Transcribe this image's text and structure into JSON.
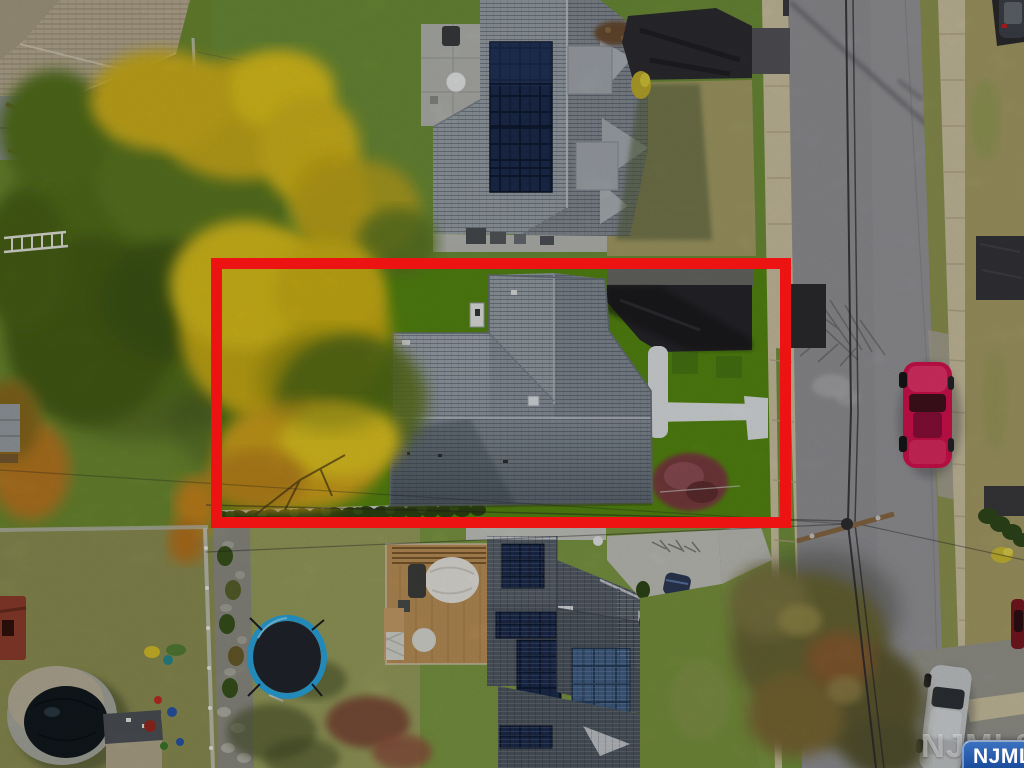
{
  "watermark": {
    "background_text": "NJMLS",
    "badge_text": "NJMLS",
    "badge_gradient_top": "#3b72c0",
    "badge_gradient_bottom": "#143e86",
    "badge_text_color": "#ffffff"
  },
  "annotation": {
    "boundary_color": "#ee1313",
    "boundary_style": "rectangle-outline",
    "highlighted_area": "subject property lot"
  },
  "scene": {
    "type": "aerial-drone-photo",
    "palette": {
      "subject_lawn_green": "#568912",
      "autumn_yellow": "#dcc01d",
      "autumn_orange": "#c8861c",
      "subject_roof_gray": "#8f98a1",
      "driveway_asphalt": "#26262b",
      "street_gray": "#97979b",
      "sidewalk_tan": "#cdc2a2",
      "dry_grass_olive": "#a79e66",
      "burgundy_shrub": "#7c3d41",
      "trampoline_blue": "#2aa7e2",
      "red_parked_car": "#d81350",
      "solar_panel_navy": "#1c2a4c"
    },
    "objects": [
      "subject-house-roof",
      "subject-lawn",
      "subject-driveway",
      "subject-walkway",
      "burgundy-shrub",
      "hedge-row-fence",
      "autumn-trees",
      "north-neighbor-solar-house",
      "south-neighbor-solar-house",
      "wood-deck-pergola",
      "trampoline",
      "covered-pool",
      "storage-shed",
      "street",
      "sidewalks",
      "utility-pole-power-lines",
      "red-parked-car",
      "silver-parked-car",
      "dark-parked-car"
    ]
  }
}
